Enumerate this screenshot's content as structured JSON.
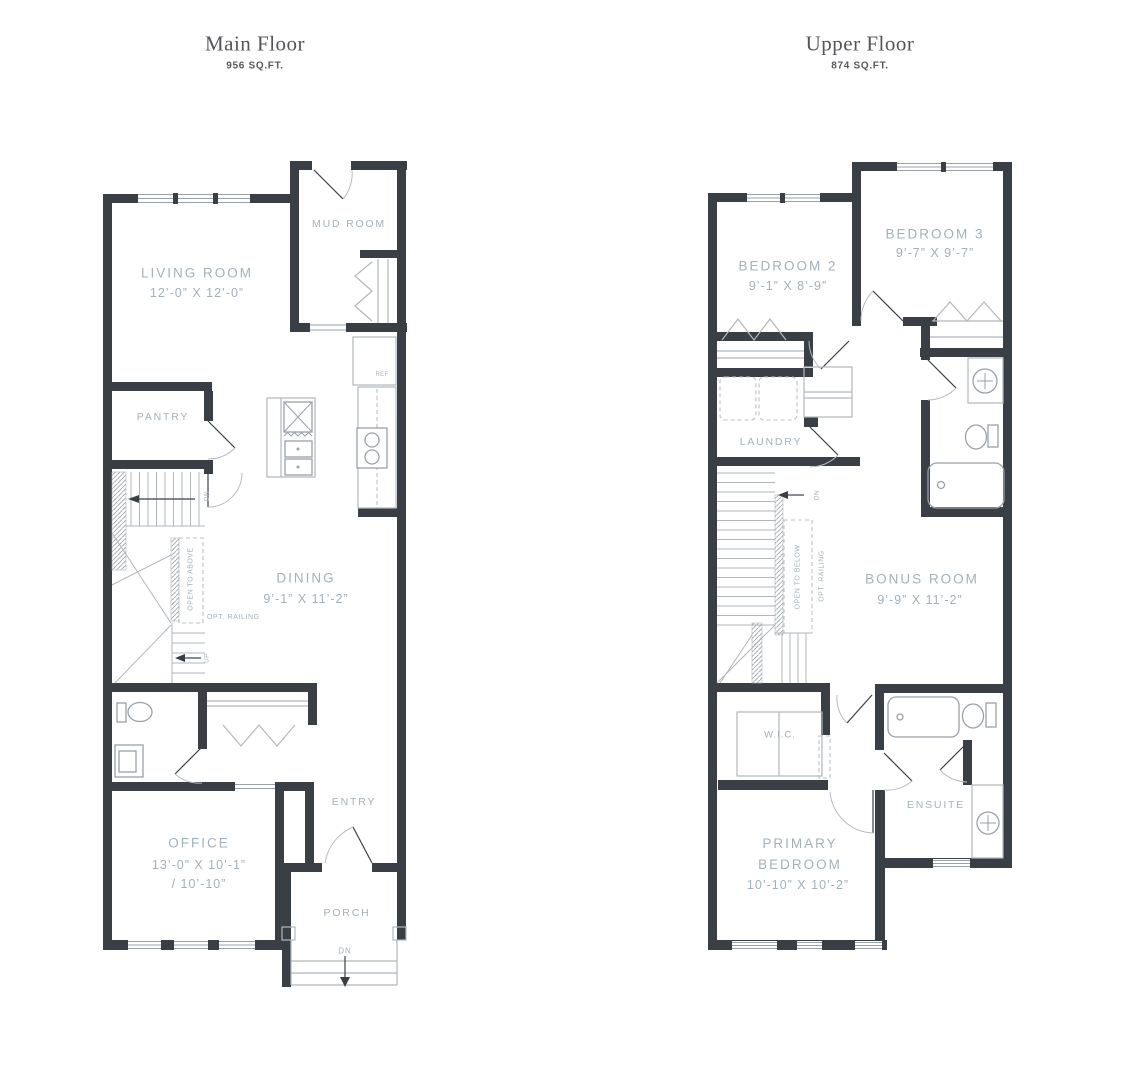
{
  "floors": {
    "main": {
      "title": "Main Floor",
      "area": "956 SQ.FT.",
      "labels": {
        "living_name": "LIVING ROOM",
        "living_dims": "12’-0” X 12’-0”",
        "mud_room": "MUD ROOM",
        "pantry": "PANTRY",
        "ref": "REF",
        "stairs_dn": "DN",
        "open_to_above": "OPEN TO ABOVE",
        "opt_railing": "OPT. RAILING",
        "stairs_up": "UP",
        "dining_name": "DINING",
        "dining_dims": "9’-1” X 11’-2”",
        "office_name": "OFFICE",
        "office_dims": "13’-0” X 10’-1”",
        "office_dims2": "/ 10’-10”",
        "entry": "ENTRY",
        "porch": "PORCH",
        "porch_dn": "DN"
      }
    },
    "upper": {
      "title": "Upper Floor",
      "area": "874 SQ.FT.",
      "labels": {
        "bedroom2_name": "BEDROOM 2",
        "bedroom2_dims": "9’-1” X 8’-9”",
        "bedroom3_name": "BEDROOM 3",
        "bedroom3_dims": "9’-7” X 9’-7”",
        "laundry": "LAUNDRY",
        "stairs_dn": "DN",
        "open_to_below": "OPEN TO BELOW",
        "opt_railing": "OPT. RAILING",
        "bonus_name": "BONUS ROOM",
        "bonus_dims": "9’-9” X 11’-2”",
        "wic": "W.I.C.",
        "ensuite": "ENSUITE",
        "primary_name": "PRIMARY BEDROOM",
        "primary_dims": "10’-10” X 10’-2”"
      }
    }
  },
  "colors": {
    "wall": "#3a3f45",
    "label": "#a3b1bb",
    "thin_line": "#b2b7bb"
  }
}
